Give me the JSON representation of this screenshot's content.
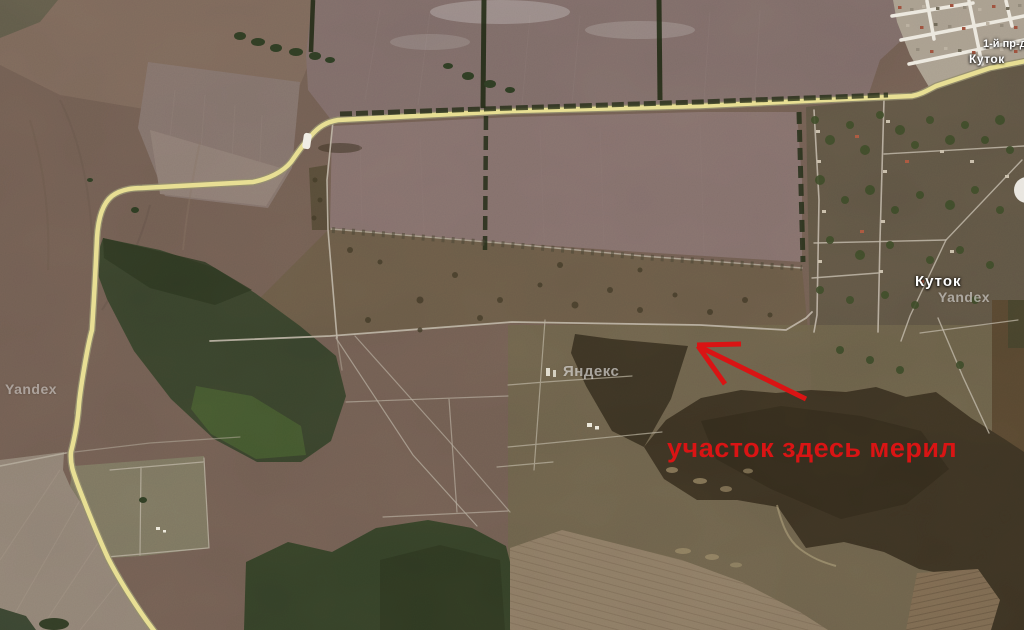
{
  "map": {
    "type": "satellite",
    "annotation": {
      "text": "участок здесь мерил",
      "color": "#d91414"
    },
    "place_labels": {
      "village": "Куток",
      "village_small": "Куток",
      "street": "1-й пр-д"
    },
    "watermarks": {
      "center": "Яндекс",
      "left": "Yandex",
      "right": "Yandex"
    },
    "colors": {
      "highway_yellow": "#e7dd8f",
      "plowed_field": "#7c6a67",
      "forest_dark_brown": "#3a3122",
      "forest_green": "#35412a",
      "scrub_base": "#6f5c51",
      "road_light": "#b5ac9e",
      "label_white": "#ffffff"
    }
  }
}
